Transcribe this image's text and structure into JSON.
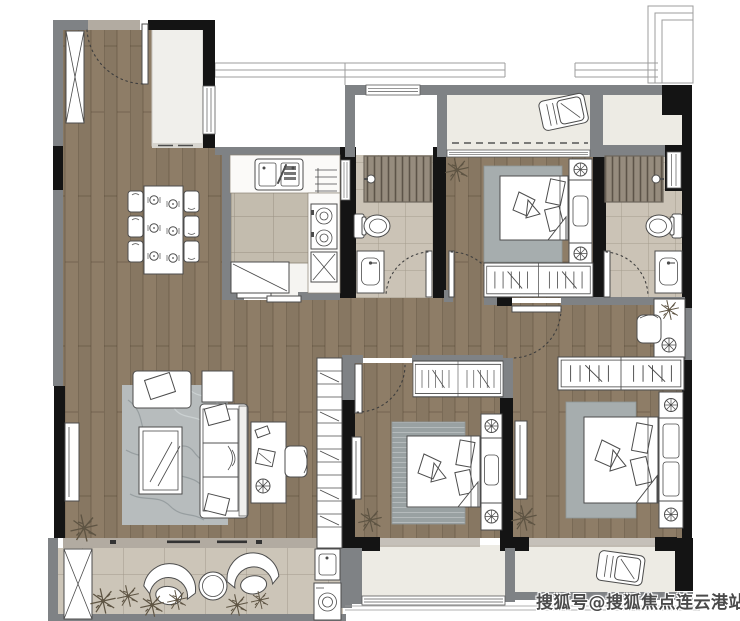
{
  "watermark": {
    "text": "搜狐号@搜狐焦点连云港站"
  },
  "palette": {
    "wood": "#8e7d67",
    "wall_gray": "#7f8285",
    "wall_black": "#141414",
    "bath_tile": "#cbc3b6",
    "kitchen_tile": "#c3bcae",
    "balcony_tile": "#ccc5b8",
    "light_floor": "#edebe4",
    "shower_base": "#968c7e",
    "stone_sill": "#b2aba1",
    "foyer_floor": "#f0efeb",
    "rug_marble": "#b7bcbd",
    "rug_gray": "#a6adae",
    "rug_dark": "#99a1a2",
    "furniture_line": "#4c4c4c",
    "watermark_color": "#4a4a4a"
  },
  "symbols": [
    "entry-door",
    "shoe-cabinet",
    "dining-table",
    "dining-chair",
    "kitchen-sink",
    "stove",
    "kitchen-cabinet",
    "drying-rack",
    "toilet",
    "shower-area",
    "shower-head",
    "vanity-basin",
    "bed",
    "pillow",
    "nightstand",
    "ceiling-lamp",
    "wardrobe",
    "bookshelf",
    "sofa",
    "armchair",
    "side-table",
    "coffee-table",
    "tv",
    "desk",
    "desk-chair",
    "lounge-chair",
    "balcony-chair",
    "balcony-table",
    "washing-machine",
    "laundry-sink",
    "plant",
    "ac-unit",
    "door-swing-arc",
    "window",
    "sliding-door"
  ]
}
